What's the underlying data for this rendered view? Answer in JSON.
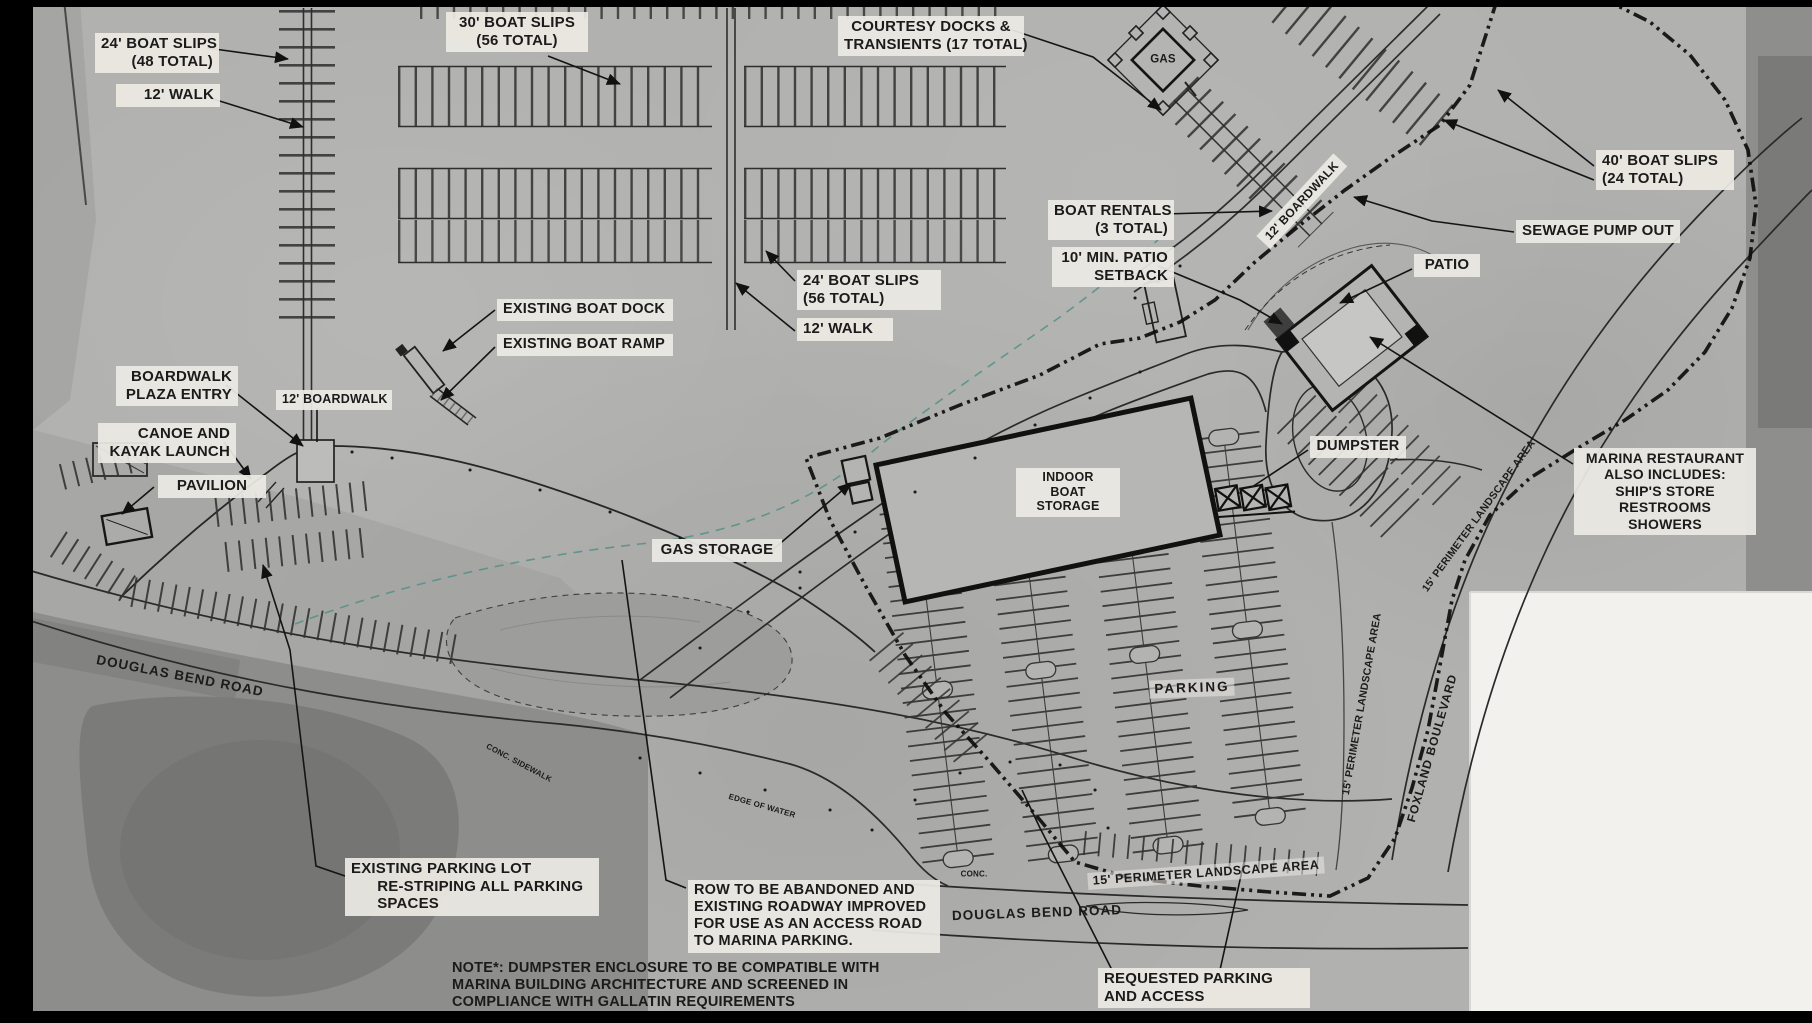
{
  "drawing": {
    "title_semantic": "marina-site-plan",
    "colors": {
      "background": "#b1b1af",
      "label_background": "#ECEAE3",
      "ink": "#141414",
      "boundary_line": "#0d0d0d",
      "water_edge_teal": "#528f8a",
      "photo_dark": "#8d8d8b",
      "sheet_white": "#f2f1ee",
      "frame": "#000000"
    }
  },
  "labels": [
    {
      "id": "boat-slips-24-48",
      "lines": [
        "24' BOAT SLIPS",
        "(48 TOTAL)"
      ],
      "x": 95,
      "y": 33,
      "w": 112,
      "align": "right",
      "fs": 15,
      "bg": true
    },
    {
      "id": "walk-12-top",
      "lines": [
        "12' WALK"
      ],
      "x": 116,
      "y": 84,
      "w": 92,
      "align": "right",
      "fs": 15,
      "bg": true
    },
    {
      "id": "boat-slips-30",
      "lines": [
        "30' BOAT SLIPS",
        "(56 TOTAL)"
      ],
      "x": 446,
      "y": 12,
      "w": 130,
      "align": "center",
      "fs": 15,
      "bg": true
    },
    {
      "id": "courtesy-docks",
      "lines": [
        "COURTESY DOCKS &",
        "TRANSIENTS (17 TOTAL)"
      ],
      "x": 838,
      "y": 16,
      "w": 174,
      "align": "center",
      "fs": 15,
      "bg": true
    },
    {
      "id": "boat-slips-40",
      "lines": [
        "40' BOAT SLIPS",
        "(24 TOTAL)"
      ],
      "x": 1596,
      "y": 150,
      "w": 126,
      "align": "left",
      "fs": 15,
      "bg": true
    },
    {
      "id": "sewage-pump-out",
      "lines": [
        "SEWAGE PUMP OUT"
      ],
      "x": 1516,
      "y": 220,
      "w": 152,
      "align": "left",
      "fs": 15,
      "bg": true
    },
    {
      "id": "boat-rentals",
      "lines": [
        "BOAT RENTALS",
        "(3 TOTAL)"
      ],
      "x": 1048,
      "y": 200,
      "w": 114,
      "align": "right",
      "fs": 15,
      "bg": true
    },
    {
      "id": "patio-setback",
      "lines": [
        "10' MIN. PATIO",
        "SETBACK"
      ],
      "x": 1052,
      "y": 247,
      "w": 110,
      "align": "right",
      "fs": 15,
      "bg": true
    },
    {
      "id": "patio",
      "lines": [
        "PATIO"
      ],
      "x": 1414,
      "y": 254,
      "w": 54,
      "align": "center",
      "fs": 15,
      "bg": true
    },
    {
      "id": "boat-slips-24-56",
      "lines": [
        "24' BOAT SLIPS",
        "(56 TOTAL)"
      ],
      "x": 797,
      "y": 270,
      "w": 132,
      "align": "left",
      "fs": 15,
      "bg": true
    },
    {
      "id": "walk-12-mid",
      "lines": [
        "12' WALK"
      ],
      "x": 797,
      "y": 318,
      "w": 84,
      "align": "left",
      "fs": 15,
      "bg": true
    },
    {
      "id": "existing-boat-dock",
      "lines": [
        "EXISTING BOAT DOCK"
      ],
      "x": 497,
      "y": 299,
      "w": 164,
      "align": "left",
      "fs": 14.5,
      "bg": true
    },
    {
      "id": "existing-boat-ramp",
      "lines": [
        "EXISTING BOAT RAMP"
      ],
      "x": 497,
      "y": 334,
      "w": 164,
      "align": "left",
      "fs": 14.5,
      "bg": true
    },
    {
      "id": "boardwalk-plaza-entry",
      "lines": [
        "BOARDWALK",
        "PLAZA ENTRY"
      ],
      "x": 116,
      "y": 366,
      "w": 110,
      "align": "right",
      "fs": 15,
      "bg": true
    },
    {
      "id": "boardwalk-12-tag",
      "lines": [
        "12' BOARDWALK"
      ],
      "x": 276,
      "y": 390,
      "w": 104,
      "align": "center",
      "fs": 12.5,
      "bg": true
    },
    {
      "id": "canoe-kayak-launch",
      "lines": [
        "CANOE AND",
        "KAYAK LAUNCH"
      ],
      "x": 98,
      "y": 423,
      "w": 126,
      "align": "right",
      "fs": 15,
      "bg": true
    },
    {
      "id": "pavilion",
      "lines": [
        "PAVILION"
      ],
      "x": 158,
      "y": 475,
      "w": 96,
      "align": "center",
      "fs": 15,
      "bg": true
    },
    {
      "id": "gas-storage",
      "lines": [
        "GAS STORAGE"
      ],
      "x": 652,
      "y": 539,
      "w": 118,
      "align": "center",
      "fs": 15,
      "bg": true
    },
    {
      "id": "indoor-boat-storage",
      "lines": [
        "INDOOR",
        "BOAT",
        "STORAGE"
      ],
      "x": 1016,
      "y": 468,
      "w": 92,
      "align": "center",
      "fs": 12.5,
      "bg": true
    },
    {
      "id": "dumpster",
      "lines": [
        "DUMPSTER"
      ],
      "x": 1310,
      "y": 436,
      "w": 84,
      "align": "center",
      "fs": 14.5,
      "bg": true
    },
    {
      "id": "marina-restaurant",
      "lines": [
        "MARINA RESTAURANT",
        "ALSO INCLUDES:",
        "SHIP'S STORE",
        "RESTROOMS",
        "SHOWERS"
      ],
      "x": 1574,
      "y": 448,
      "w": 170,
      "align": "center",
      "fs": 14,
      "bg": true
    },
    {
      "id": "existing-parking-lot",
      "lines": [
        "EXISTING PARKING LOT",
        "      RE-STRIPING ALL PARKING",
        "      SPACES"
      ],
      "x": 345,
      "y": 858,
      "w": 242,
      "align": "left",
      "fs": 15,
      "bg": true
    },
    {
      "id": "row-abandoned",
      "lines": [
        "ROW TO BE ABANDONED AND",
        "EXISTING ROADWAY IMPROVED",
        "FOR USE AS AN ACCESS ROAD",
        "TO MARINA PARKING."
      ],
      "x": 688,
      "y": 880,
      "w": 240,
      "align": "left",
      "fs": 14.5,
      "bg": true
    },
    {
      "id": "requested-parking",
      "lines": [
        "REQUESTED PARKING",
        "AND ACCESS"
      ],
      "x": 1098,
      "y": 968,
      "w": 200,
      "align": "left",
      "fs": 15,
      "bg": true
    },
    {
      "id": "note-dumpster",
      "lines": [
        "NOTE*: DUMPSTER ENCLOSURE TO BE COMPATIBLE WITH",
        "MARINA BUILDING ARCHITECTURE AND SCREENED IN",
        "COMPLIANCE WITH GALLATIN REQUIREMENTS"
      ],
      "x": 452,
      "y": 960,
      "w": 440,
      "align": "left",
      "fs": 14.5,
      "bg": false
    },
    {
      "id": "gas-island",
      "lines": [
        "GAS"
      ],
      "cx": 1163,
      "cy": 60,
      "rot": 0,
      "fs": 11.5,
      "bg": false,
      "align": "center"
    },
    {
      "id": "parking-area",
      "lines": [
        "PARKING"
      ],
      "cx": 1192,
      "cy": 688,
      "rot": -2,
      "fs": 13.5,
      "bg": "faint",
      "ls": 2
    },
    {
      "id": "perimeter-landscape-bottom",
      "lines": [
        "15' PERIMETER LANDSCAPE AREA"
      ],
      "cx": 1206,
      "cy": 873,
      "rot": -4,
      "fs": 12.5,
      "bg": "faint",
      "ls": 0.5
    },
    {
      "id": "douglas-bend-road-w",
      "lines": [
        "DOUGLAS BEND ROAD"
      ],
      "cx": 180,
      "cy": 676,
      "rot": 11,
      "fs": 13.5,
      "bg": false,
      "ls": 1
    },
    {
      "id": "douglas-bend-road-s",
      "lines": [
        "DOUGLAS BEND ROAD"
      ],
      "cx": 1037,
      "cy": 913,
      "rot": -2,
      "fs": 13.5,
      "bg": false,
      "ls": 1
    },
    {
      "id": "boardwalk-12-ne",
      "lines": [
        "12' BOARDWALK"
      ],
      "cx": 1302,
      "cy": 201,
      "rot": -47,
      "fs": 12,
      "bg": true
    },
    {
      "id": "perimeter-landscape-e1",
      "lines": [
        "15' PERIMETER LANDSCAPE AREA"
      ],
      "cx": 1479,
      "cy": 516,
      "rot": -54,
      "fs": 10.5,
      "bg": false
    },
    {
      "id": "perimeter-landscape-e2",
      "lines": [
        "15' PERIMETER LANDSCAPE AREA"
      ],
      "cx": 1362,
      "cy": 704,
      "rot": -80,
      "fs": 10.5,
      "bg": false
    },
    {
      "id": "foxland-boulevard",
      "lines": [
        "FOXLAND BOULEVARD"
      ],
      "cx": 1432,
      "cy": 748,
      "rot": -74,
      "fs": 12,
      "bg": false,
      "ls": 1
    },
    {
      "id": "conc-sidewalk",
      "lines": [
        "CONC. SIDEWALK"
      ],
      "cx": 519,
      "cy": 763,
      "rot": 28,
      "fs": 8,
      "bg": false
    },
    {
      "id": "edge-of-water",
      "lines": [
        "EDGE OF WATER"
      ],
      "cx": 762,
      "cy": 806,
      "rot": 16,
      "fs": 8,
      "bg": false
    },
    {
      "id": "conc",
      "lines": [
        "CONC."
      ],
      "cx": 974,
      "cy": 874,
      "rot": 0,
      "fs": 8,
      "bg": false
    }
  ]
}
